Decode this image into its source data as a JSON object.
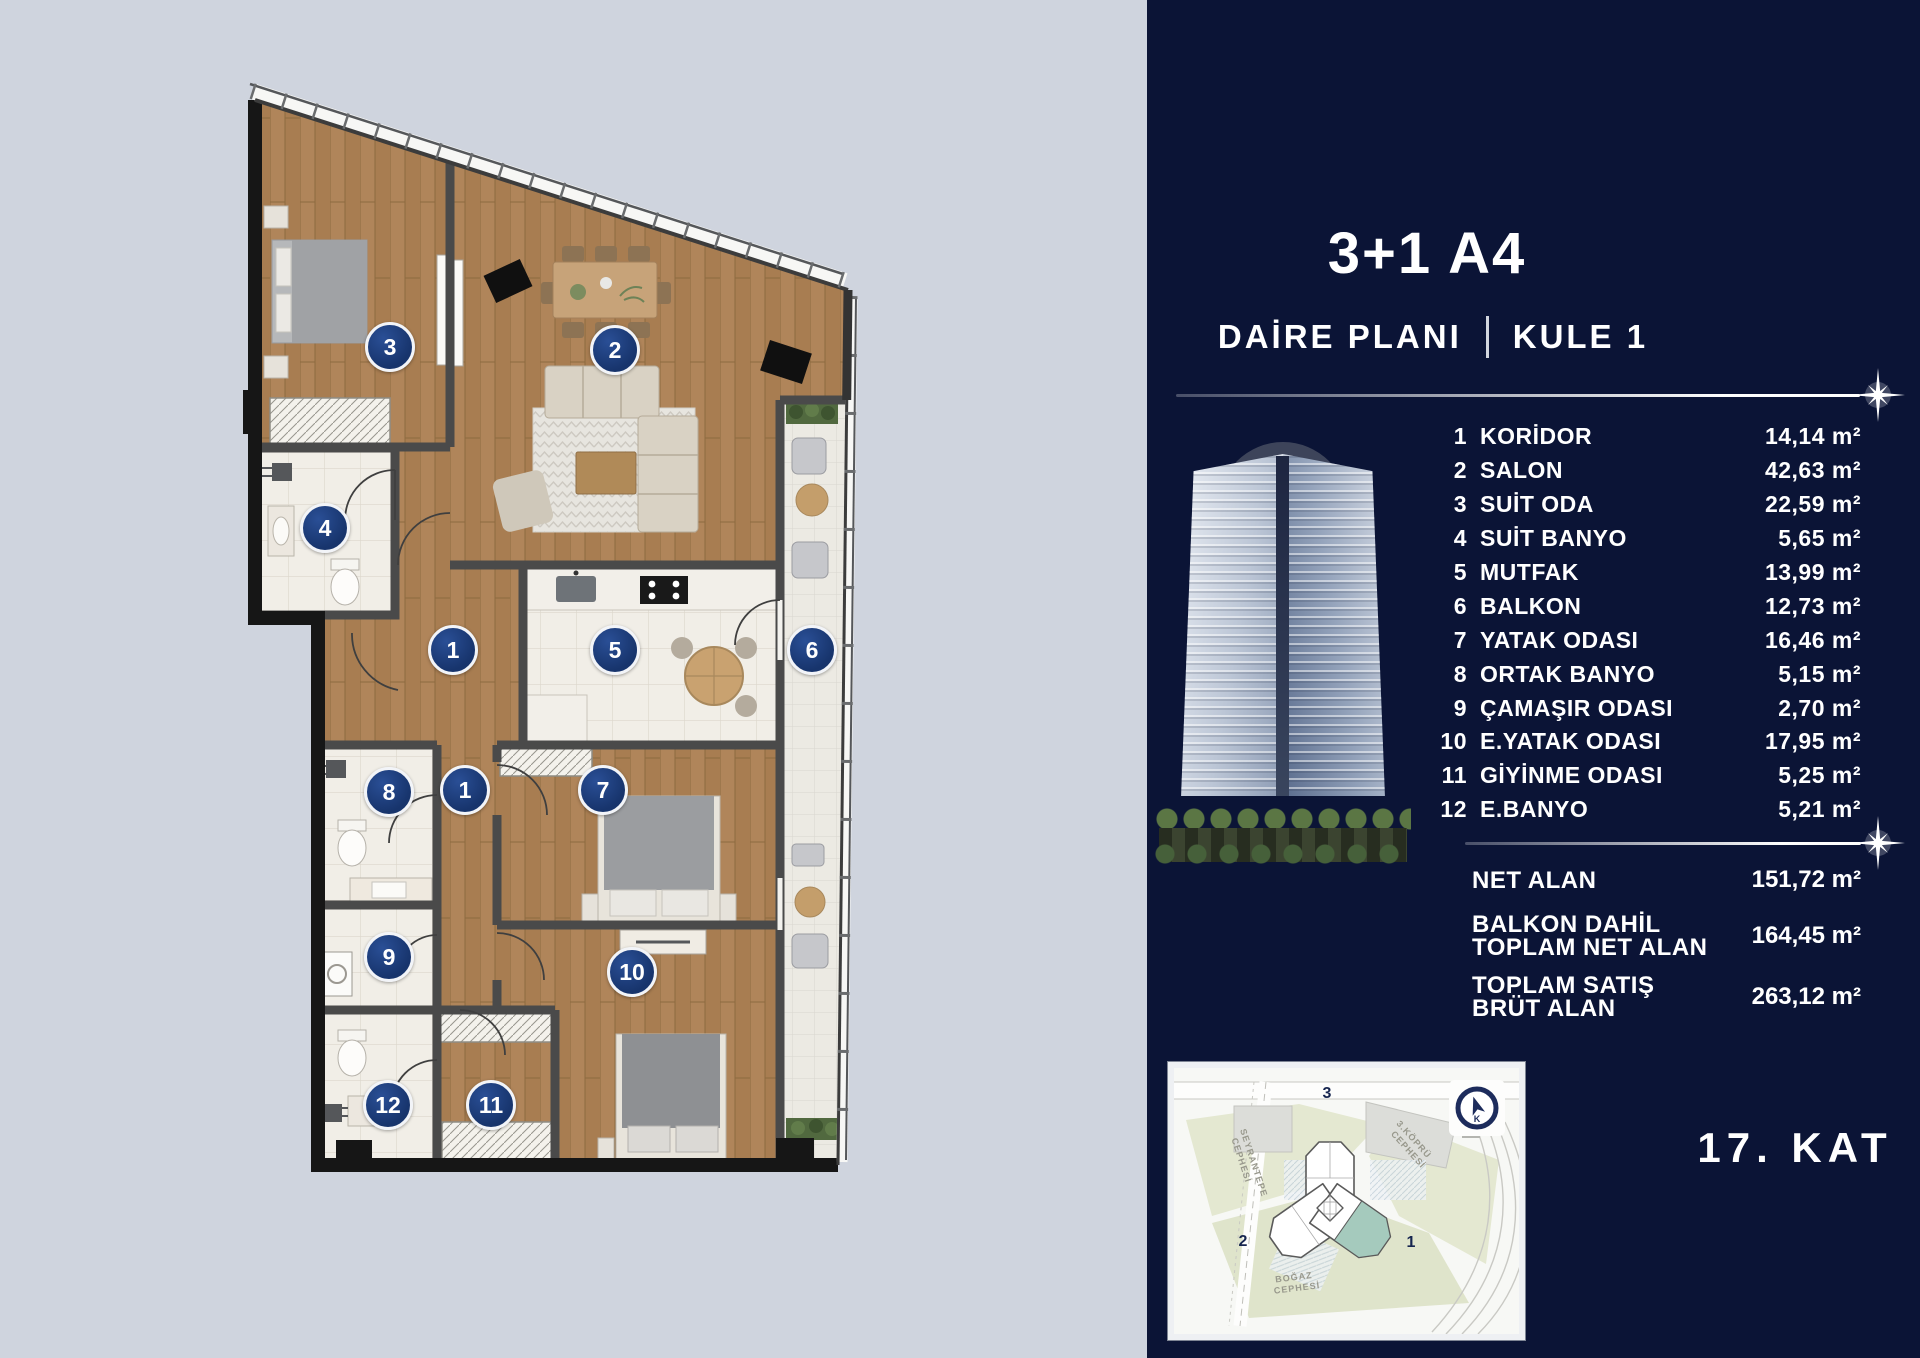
{
  "header": {
    "title": "3+1 A4",
    "plan_label": "DAİRE PLANI",
    "tower_label": "KULE 1"
  },
  "rooms": [
    {
      "no": "1",
      "name": "KORİDOR",
      "area": "14,14 m²"
    },
    {
      "no": "2",
      "name": "SALON",
      "area": "42,63 m²"
    },
    {
      "no": "3",
      "name": "SUİT ODA",
      "area": "22,59 m²"
    },
    {
      "no": "4",
      "name": "SUİT BANYO",
      "area": "5,65 m²"
    },
    {
      "no": "5",
      "name": "MUTFAK",
      "area": "13,99 m²"
    },
    {
      "no": "6",
      "name": "BALKON",
      "area": "12,73 m²"
    },
    {
      "no": "7",
      "name": "YATAK ODASI",
      "area": "16,46 m²"
    },
    {
      "no": "8",
      "name": "ORTAK BANYO",
      "area": "5,15 m²"
    },
    {
      "no": "9",
      "name": "ÇAMAŞIR ODASI",
      "area": "2,70 m²"
    },
    {
      "no": "10",
      "name": "E.YATAK ODASI",
      "area": "17,95 m²"
    },
    {
      "no": "11",
      "name": "GİYİNME ODASI",
      "area": "5,25 m²"
    },
    {
      "no": "12",
      "name": "E.BANYO",
      "area": "5,21 m²"
    }
  ],
  "summary": [
    {
      "line1": "NET ALAN",
      "line2": "",
      "area": "151,72 m²"
    },
    {
      "line1": "BALKON DAHİL",
      "line2": "TOPLAM NET ALAN",
      "area": "164,45 m²"
    },
    {
      "line1": "TOPLAM SATIŞ",
      "line2": "BRÜT ALAN",
      "area": "263,12 m²"
    }
  ],
  "floor_label": "17. KAT",
  "plan": {
    "markers": [
      "3",
      "2",
      "4",
      "1",
      "5",
      "6",
      "8",
      "1",
      "7",
      "9",
      "10",
      "12",
      "11"
    ]
  },
  "minimap": {
    "street_left_1": "SEYRANTEPE",
    "street_left_2": "CEPHESİ",
    "street_right_1": "3.KÖPRÜ",
    "street_right_2": "CEPHESİ",
    "street_bottom_1": "BOĞAZ",
    "street_bottom_2": "CEPHESİ",
    "wing_top": "3",
    "wing_left": "2",
    "wing_right": "1",
    "compass": "K"
  },
  "colors": {
    "background": "#cfd4de",
    "sidebar_bg": "#0b1436",
    "badge_blue": "#1c3d7c",
    "wood": "#b0855a",
    "map_teal": "#a5cabd"
  }
}
